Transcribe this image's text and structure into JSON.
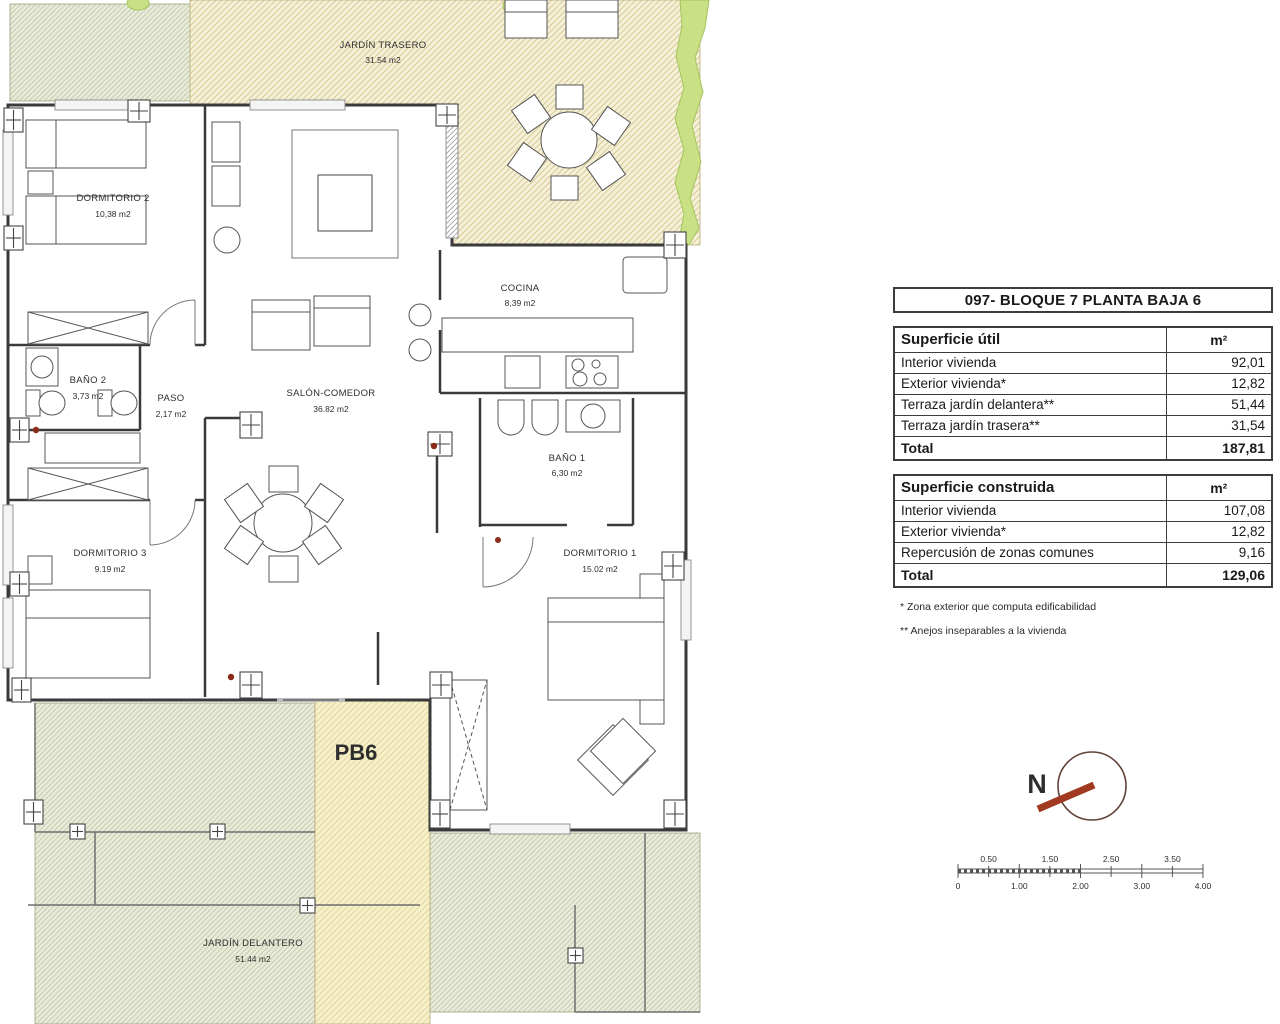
{
  "panel": {
    "title": "097- BLOQUE 7 PLANTA BAJA 6",
    "util": {
      "header": "Superficie útil",
      "unit": "m²",
      "rows": [
        {
          "label": "Interior vivienda",
          "value": "92,01"
        },
        {
          "label": "Exterior vivienda*",
          "value": "12,82"
        },
        {
          "label": "Terraza jardín delantera**",
          "value": "51,44"
        },
        {
          "label": "Terraza jardín trasera**",
          "value": "31,54"
        }
      ],
      "total_label": "Total",
      "total_value": "187,81"
    },
    "construida": {
      "header": "Superficie construida",
      "unit": "m²",
      "rows": [
        {
          "label": "Interior vivienda",
          "value": "107,08"
        },
        {
          "label": "Exterior vivienda*",
          "value": "12,82"
        },
        {
          "label": "Repercusión de zonas comunes",
          "value": "9,16"
        }
      ],
      "total_label": "Total",
      "total_value": "129,06"
    },
    "notes": [
      "* Zona exterior que computa edificabilidad",
      "** Anejos inseparables a la vivienda"
    ]
  },
  "plan": {
    "unit_label": "PB6",
    "rooms": [
      {
        "name": "JARDÍN TRASERO",
        "area": "31.54 m2"
      },
      {
        "name": "DORMITORIO 2",
        "area": "10,38 m2"
      },
      {
        "name": "COCINA",
        "area": "8,39 m2"
      },
      {
        "name": "BAÑO 2",
        "area": "3,73 m2"
      },
      {
        "name": "PASO",
        "area": "2,17 m2"
      },
      {
        "name": "SALÓN-COMEDOR",
        "area": "36.82 m2"
      },
      {
        "name": "BAÑO 1",
        "area": "6,30 m2"
      },
      {
        "name": "DORMITORIO 3",
        "area": "9.19 m2"
      },
      {
        "name": "DORMITORIO 1",
        "area": "15.02 m2"
      },
      {
        "name": "JARDÍN DELANTERO",
        "area": "51.44 m2"
      }
    ]
  },
  "compass": {
    "north_label": "N"
  },
  "scalebar": {
    "top_labels": [
      "0.50",
      "1.50",
      "2.50",
      "3.50"
    ],
    "bottom_labels": [
      "0",
      "1.00",
      "2.00",
      "3.00",
      "4.00"
    ]
  },
  "colors": {
    "wall": "#3a3a3a",
    "garden_tan_bg": "#f5f0d7",
    "garden_green_bg": "#eaecdb",
    "path_bg": "#f6f1cb",
    "hedge": "#c9e085",
    "compass_red": "#a13a20",
    "north_red": "#8c2d1c"
  }
}
